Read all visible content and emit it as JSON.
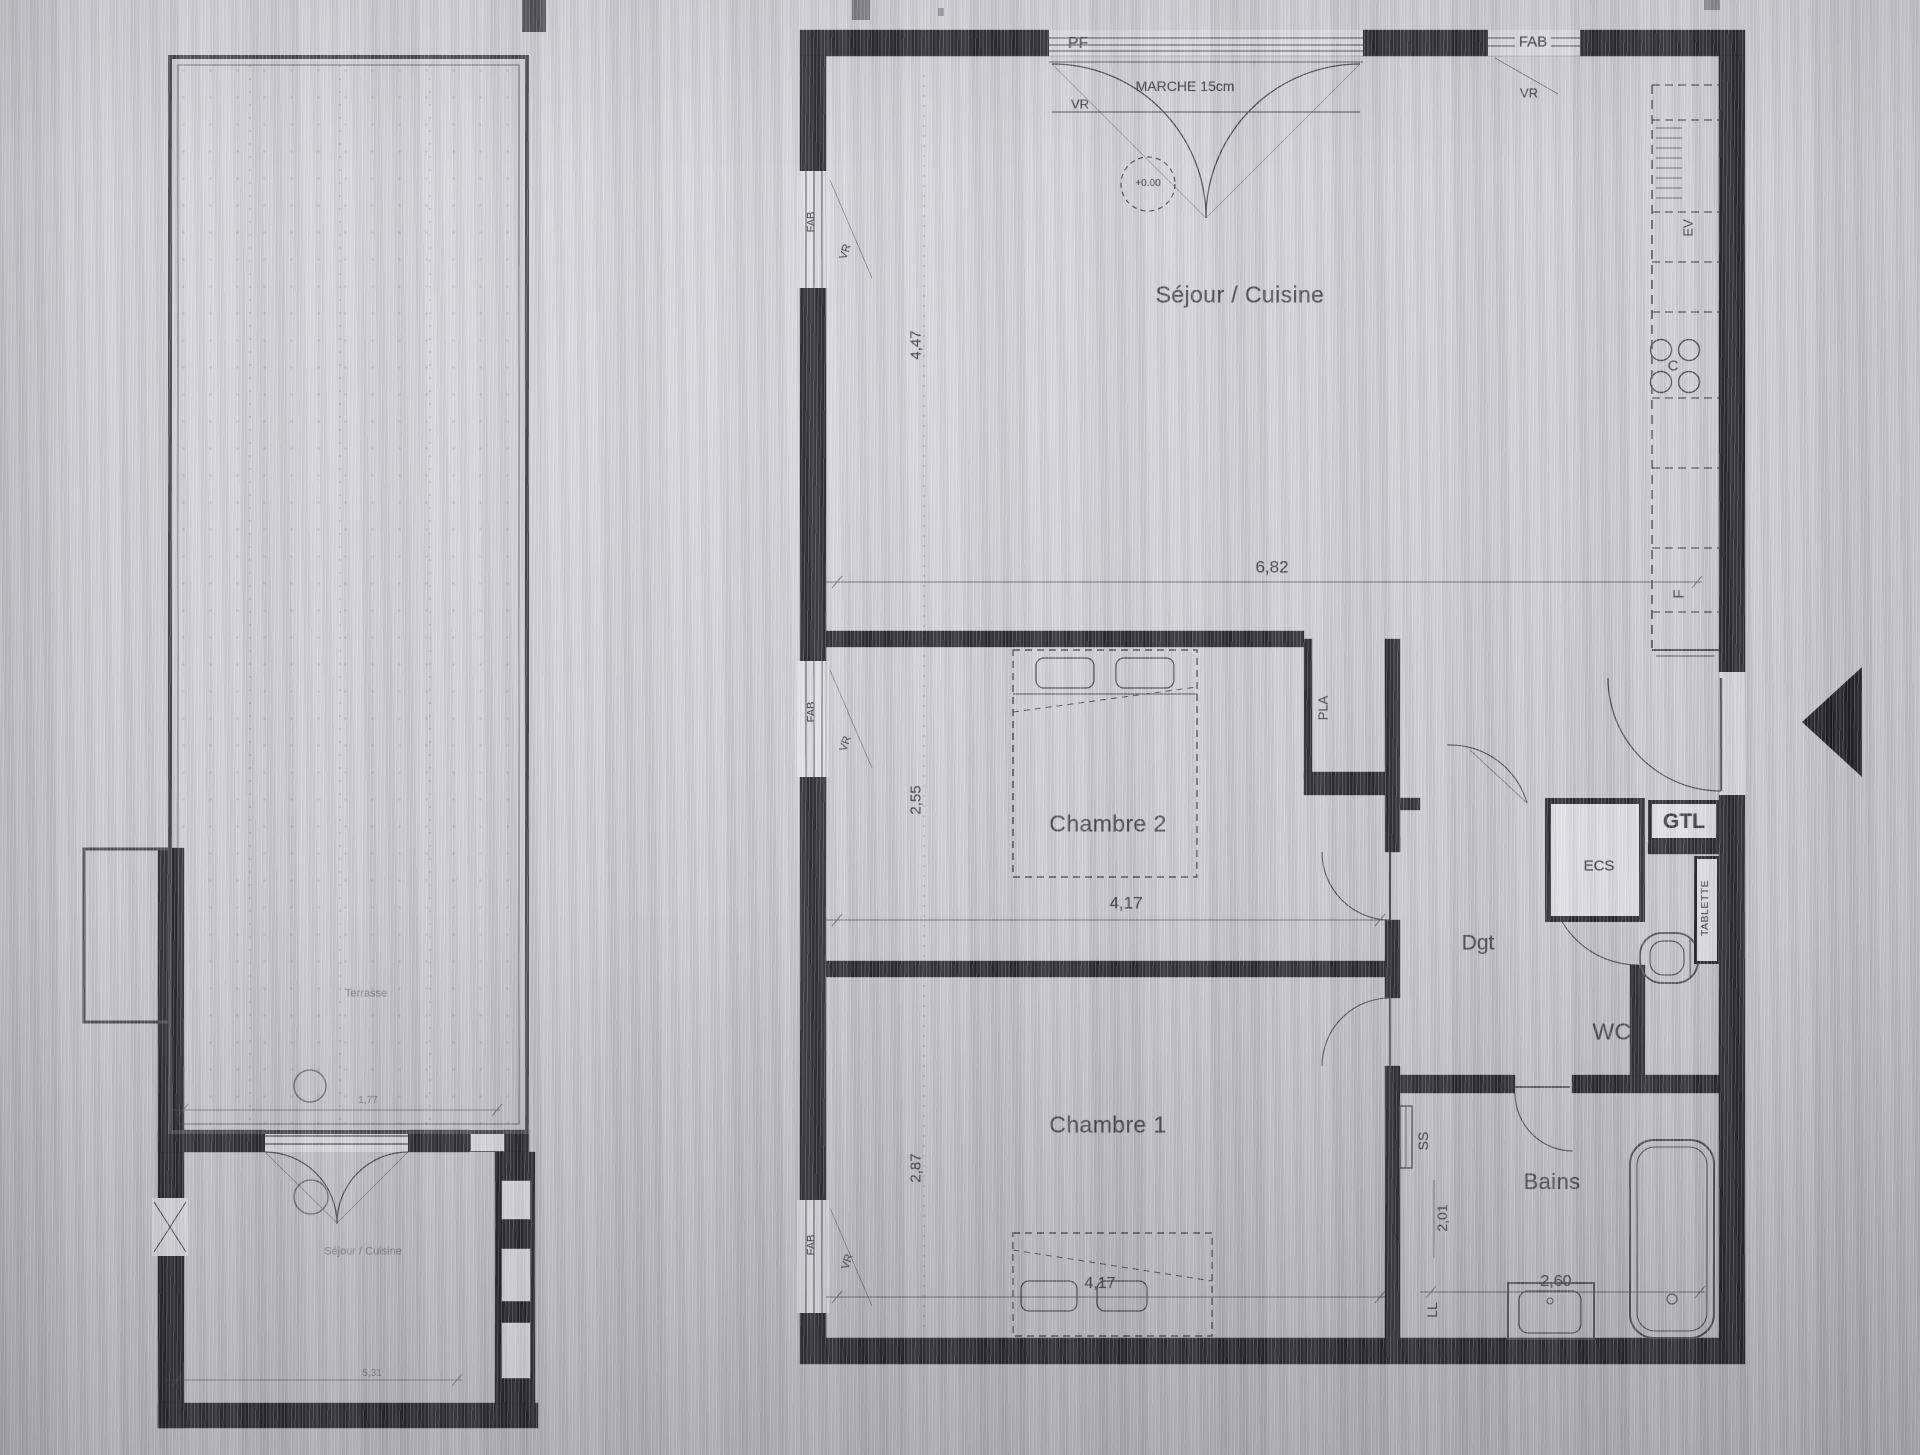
{
  "main_plan": {
    "rooms": {
      "sejour_cuisine": "Séjour / Cuisine",
      "chambre_2": "Chambre 2",
      "chambre_1": "Chambre 1",
      "bains": "Bains",
      "wc": "WC",
      "degagement": "Dgt"
    },
    "dimensions": {
      "sejour_width": "6,82",
      "sejour_height": "4,47",
      "chambre2_height": "2,55",
      "chambre2_width": "4,17",
      "chambre1_height": "2,87",
      "chambre1_width": "4,17",
      "bains_height": "2,01",
      "bains_width": "2,60"
    },
    "annotations": {
      "pf": "PF",
      "fab": "FAB",
      "vr": "VR",
      "marche": "MARCHE 15cm",
      "level": "+0.00",
      "evier": "EV",
      "cuisson": "C",
      "frigo": "F",
      "placard": "PLA",
      "ecs": "ECS",
      "gtl": "GTL",
      "tablette": "TABLETTE",
      "seche_serviettes": "SS",
      "lave_linge": "LL"
    }
  },
  "left_plan": {
    "labels": {
      "terrasse": "Terrasse",
      "sejour_cuisine": "Séjour / Cuisine"
    },
    "dimensions": {
      "upper": "1,77",
      "lower": "5,31"
    }
  }
}
